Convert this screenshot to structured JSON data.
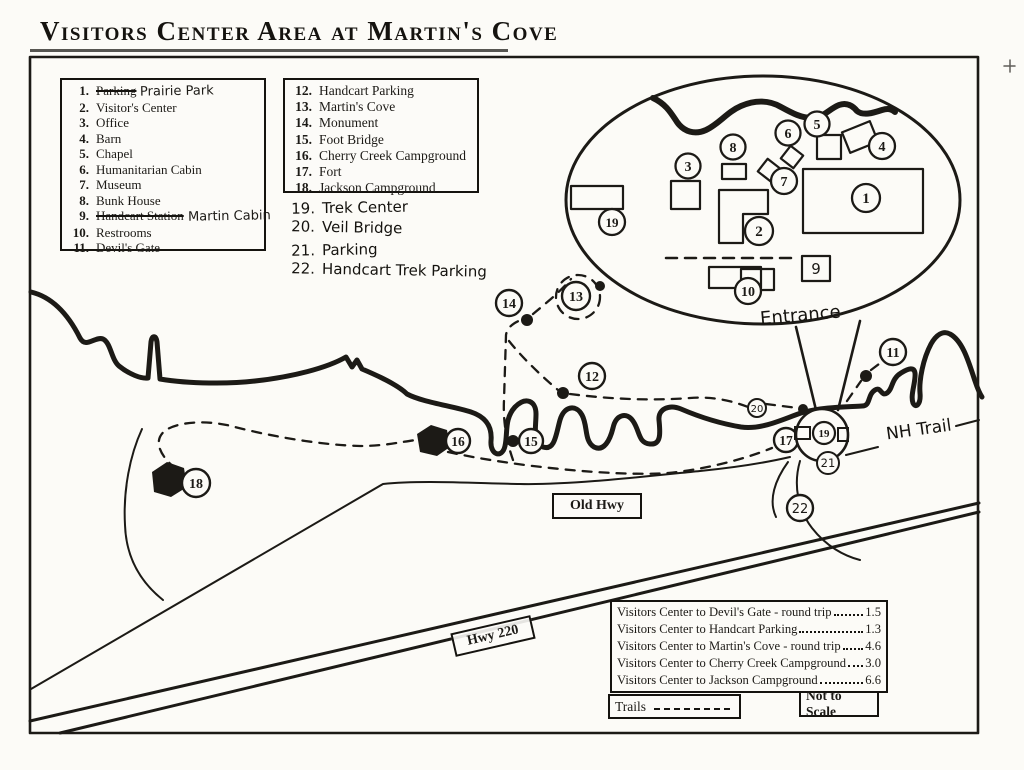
{
  "title": "Visitors Center Area at Martin's Cove",
  "legend_left": {
    "items": [
      {
        "num": "1.",
        "label": "Parking",
        "replacement": "Prairie Park"
      },
      {
        "num": "2.",
        "label": "Visitor's Center"
      },
      {
        "num": "3.",
        "label": "Office"
      },
      {
        "num": "4.",
        "label": "Barn"
      },
      {
        "num": "5.",
        "label": "Chapel"
      },
      {
        "num": "6.",
        "label": "Humanitarian Cabin"
      },
      {
        "num": "7.",
        "label": "Museum"
      },
      {
        "num": "8.",
        "label": "Bunk House"
      },
      {
        "num": "9.",
        "label": "Handcart Station",
        "replacement": "Martin Cabin"
      },
      {
        "num": "10.",
        "label": "Restrooms"
      },
      {
        "num": "11.",
        "label": "Devil's Gate"
      }
    ]
  },
  "legend_right": {
    "items": [
      {
        "num": "12.",
        "label": "Handcart Parking"
      },
      {
        "num": "13.",
        "label": "Martin's Cove"
      },
      {
        "num": "14.",
        "label": "Monument"
      },
      {
        "num": "15.",
        "label": "Foot Bridge"
      },
      {
        "num": "16.",
        "label": "Cherry Creek Campground"
      },
      {
        "num": "17.",
        "label": "Fort"
      },
      {
        "num": "18.",
        "label": "Jackson Campground"
      }
    ]
  },
  "legend_handwritten": {
    "items": [
      {
        "num": "19.",
        "label": "Trek Center"
      },
      {
        "num": "20.",
        "label": "Veil Bridge"
      },
      {
        "num": "21.",
        "label": "Parking"
      },
      {
        "num": "22.",
        "label": "Handcart Trek Parking"
      }
    ]
  },
  "distances": {
    "rows": [
      {
        "label": "Visitors Center to Devil's Gate - round trip",
        "value": "1.5"
      },
      {
        "label": "Visitors Center to Handcart Parking",
        "value": "1.3"
      },
      {
        "label": "Visitors Center to Martin's Cove - round trip",
        "value": "4.6"
      },
      {
        "label": "Visitors Center to Cherry Creek Campground",
        "value": "3.0"
      },
      {
        "label": "Visitors Center to Jackson Campground",
        "value": "6.6"
      }
    ]
  },
  "map_labels": {
    "entrance": "Entrance",
    "old_hwy": "Old Hwy",
    "hwy_220": "Hwy 220",
    "nh_trail": "NH Trail",
    "trails": "Trails",
    "not_to_scale": "Not to Scale"
  },
  "markers": {
    "m1": "1",
    "m2": "2",
    "m3": "3",
    "m4": "4",
    "m5": "5",
    "m6": "6",
    "m7": "7",
    "m8": "8",
    "m9": "9",
    "m10": "10",
    "m11": "11",
    "m12": "12",
    "m13": "13",
    "m14": "14",
    "m15": "15",
    "m16": "16",
    "m17": "17",
    "m18": "18",
    "m19": "19",
    "m20": "20",
    "m21": "21",
    "m22": "22"
  },
  "ink_color": "#1c1a16"
}
